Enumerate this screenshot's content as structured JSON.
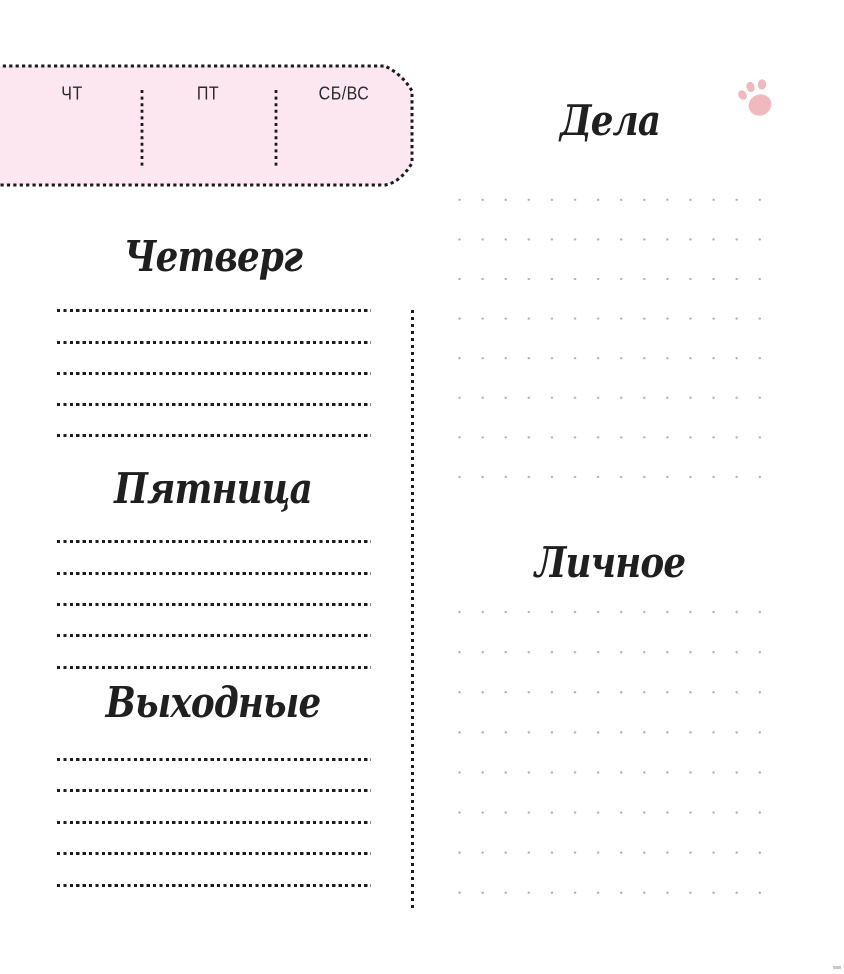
{
  "day_tab": {
    "days": [
      {
        "label": "ЧТ"
      },
      {
        "label": "ПТ"
      },
      {
        "label": "СБ/ВС"
      }
    ]
  },
  "left_column": {
    "sections": [
      {
        "title": "Четверг"
      },
      {
        "title": "Пятница"
      },
      {
        "title": "Выходные"
      }
    ]
  },
  "right_column": {
    "sections": [
      {
        "title": "Дела"
      },
      {
        "title": "Личное"
      }
    ]
  },
  "icons": {
    "paw": "paw-print"
  },
  "colors": {
    "ink": "#1c1c1c",
    "tab_fill": "#fce6f0",
    "dot_grid": "#b3b3b3",
    "paw_pink": "#f0b9be"
  }
}
